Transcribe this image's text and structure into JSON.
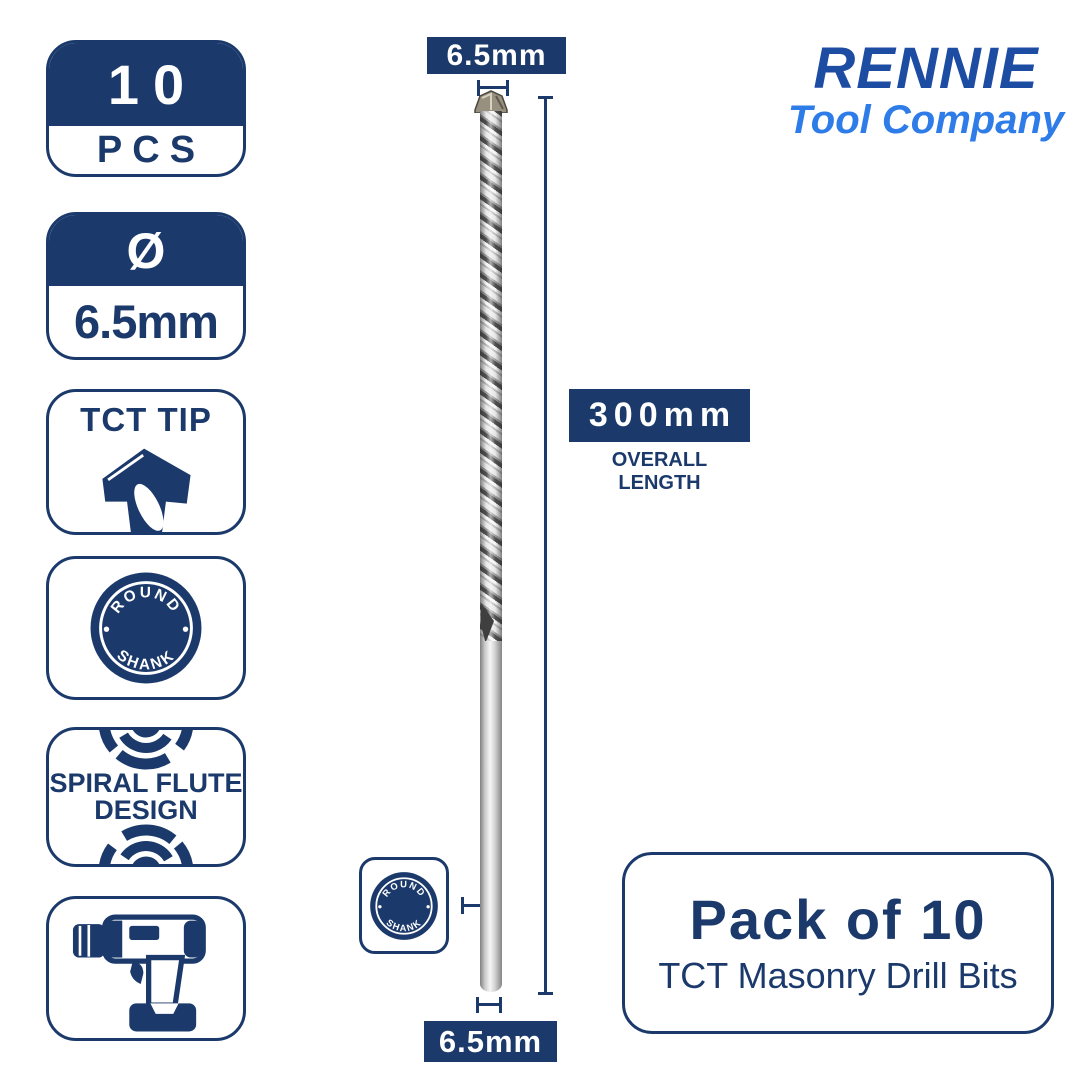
{
  "brand": {
    "name": "RENNIE",
    "tagline": "Tool Company"
  },
  "badges": {
    "pcs": {
      "value": "10",
      "unit": "PCS"
    },
    "diameter": {
      "symbol": "Ø",
      "value": "6.5mm"
    },
    "tct_tip": {
      "label": "TCT TIP"
    },
    "round_shank": {
      "top": "ROUND",
      "bottom": "SHANK"
    },
    "spiral": {
      "line1": "SPIRAL FLUTE",
      "line2": "DESIGN"
    }
  },
  "dimensions": {
    "top_diameter": "6.5mm",
    "bottom_diameter": "6.5mm",
    "overall_length": "300mm",
    "overall_length_caption": "OVERALL LENGTH"
  },
  "shank_tag": {
    "top": "ROUND",
    "bottom": "SHANK"
  },
  "pack": {
    "title": "Pack of 10",
    "subtitle": "TCT Masonry Drill Bits"
  },
  "colors": {
    "navy": "#1b3a6b",
    "brand_dark": "#1d4ca3",
    "brand_light": "#2e7ce8"
  }
}
